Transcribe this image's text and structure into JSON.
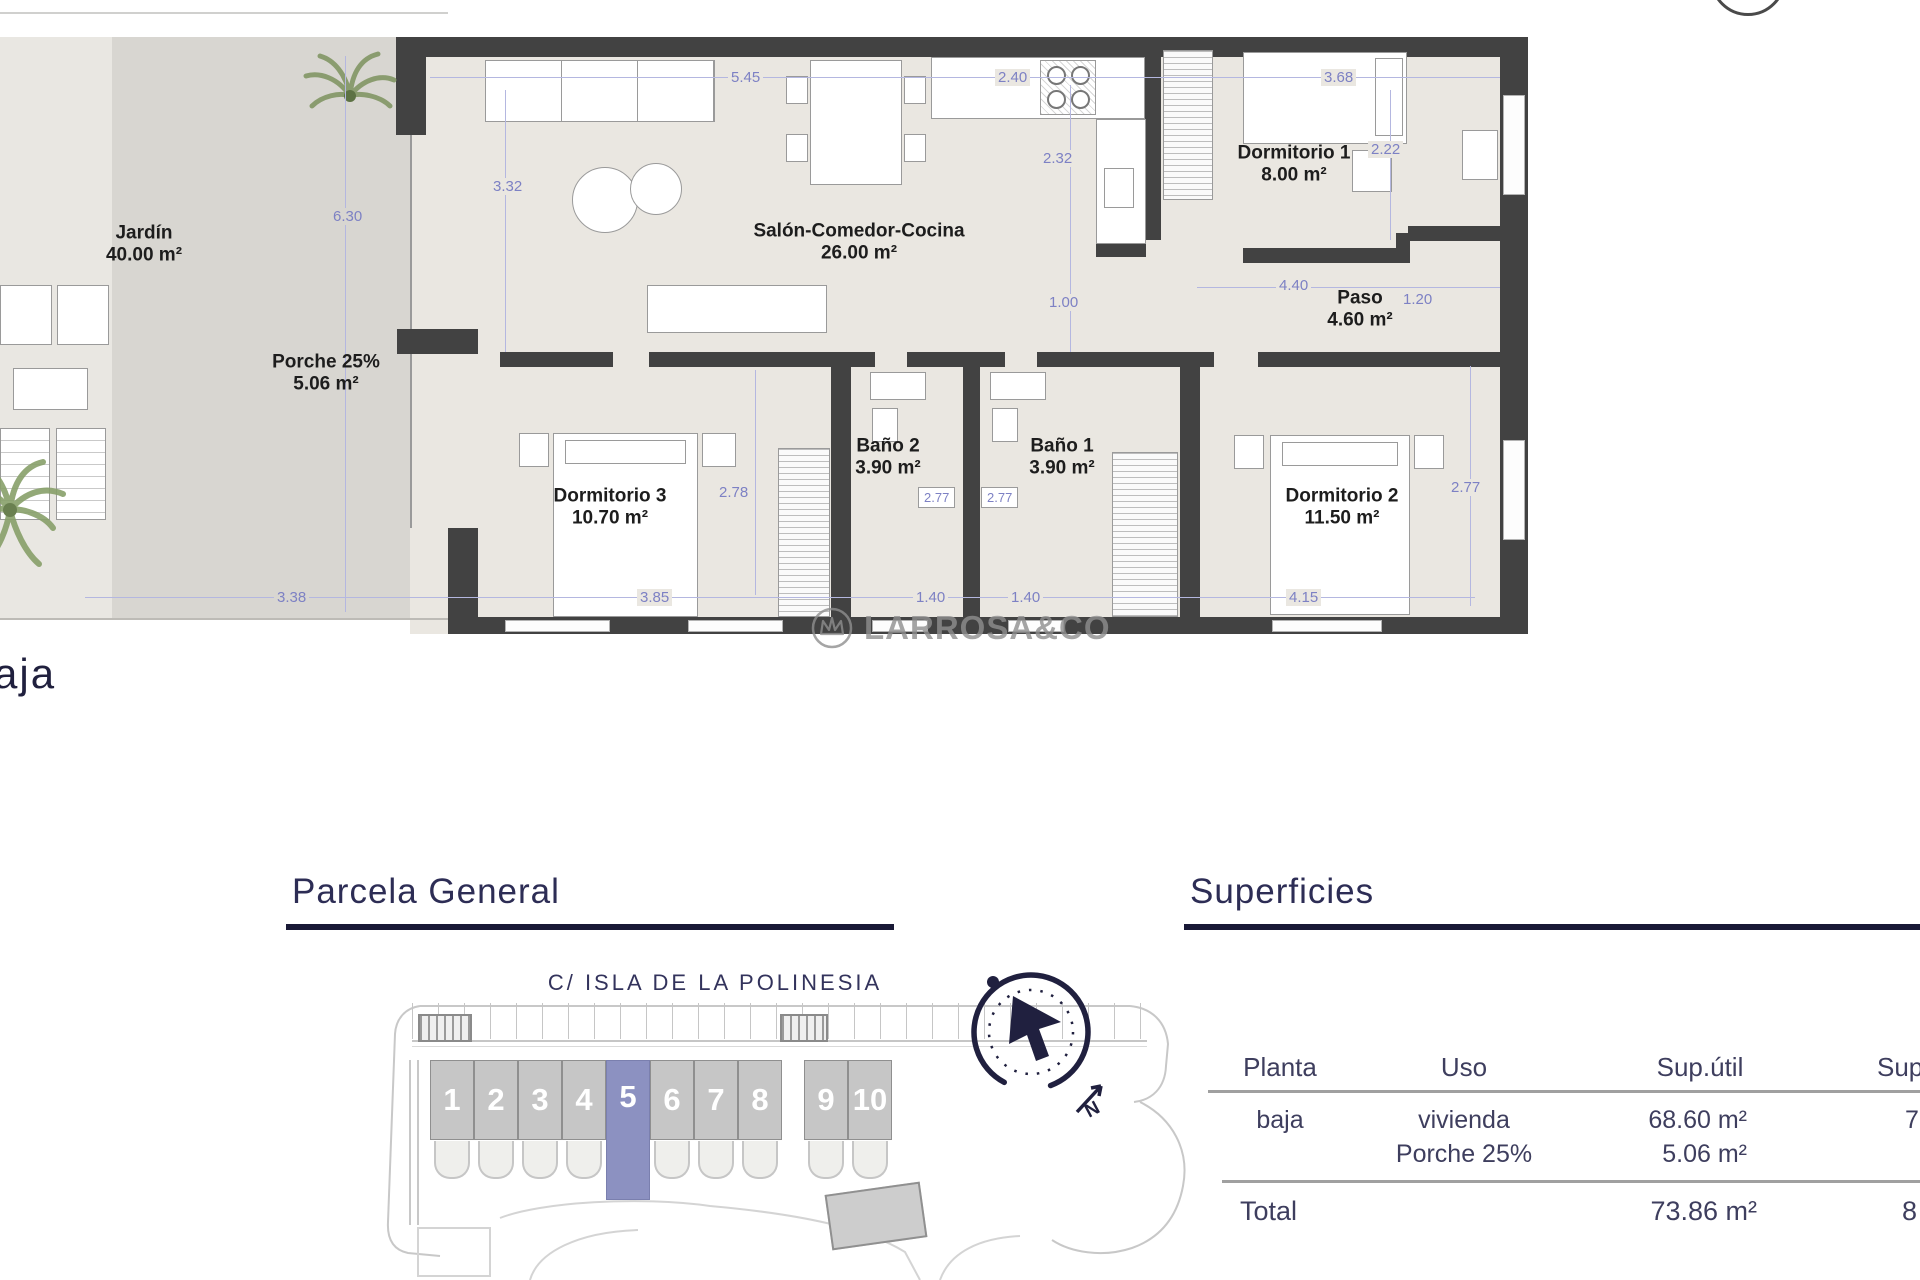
{
  "page": {
    "floor_label_partial": "aja"
  },
  "watermark": {
    "text": "LARROSA&CO"
  },
  "colors": {
    "accent_navy": "#2d2d55",
    "dimension_blue": "#7d81c4",
    "wall_gray": "#424242",
    "highlight_plot": "#8c91c1",
    "watermark_gray": "#8f8f8f"
  },
  "floor_plan": {
    "rooms": [
      {
        "name": "Jardín",
        "area": "40.00 m²"
      },
      {
        "name": "Porche 25%",
        "area": "5.06 m²"
      },
      {
        "name": "Salón-Comedor-Cocina",
        "area": "26.00 m²"
      },
      {
        "name": "Dormitorio 1",
        "area": "8.00 m²"
      },
      {
        "name": "Paso",
        "area": "4.60 m²"
      },
      {
        "name": "Baño 2",
        "area": "3.90 m²"
      },
      {
        "name": "Baño 1",
        "area": "3.90 m²"
      },
      {
        "name": "Dormitorio 3",
        "area": "10.70 m²"
      },
      {
        "name": "Dormitorio 2",
        "area": "11.50 m²"
      }
    ],
    "dims": {
      "d545": "5.45",
      "d240": "2.40",
      "d368": "3.68",
      "d222": "2.22",
      "d332": "3.32",
      "d630": "6.30",
      "d232": "2.32",
      "d100": "1.00",
      "d440": "4.40",
      "d120": "1.20",
      "d278": "2.78",
      "d277a": "2.77",
      "d277b": "2.77",
      "d277c": "2.77",
      "d338": "3.38",
      "d385": "3.85",
      "d140a": "1.40",
      "d140b": "1.40",
      "d415": "4.15"
    }
  },
  "parcela": {
    "title": "Parcela General",
    "street": "C/ ISLA DE LA POLINESIA",
    "plots": [
      "1",
      "2",
      "3",
      "4",
      "5",
      "6",
      "7",
      "8",
      "9",
      "10"
    ],
    "highlighted_plot": "5",
    "compass_letter": "N"
  },
  "superficies": {
    "title": "Superficies",
    "headers": {
      "planta": "Planta",
      "uso": "Uso",
      "sup_util": "Sup.útil",
      "sup_cut": "Sup"
    },
    "row": {
      "planta": "baja",
      "uso1": "vivienda",
      "uso2": "Porche 25%",
      "val1": "68.60 m²",
      "val2": "5.06 m²",
      "cut": "7"
    },
    "total": {
      "label": "Total",
      "value": "73.86 m²",
      "cut": "8"
    }
  }
}
